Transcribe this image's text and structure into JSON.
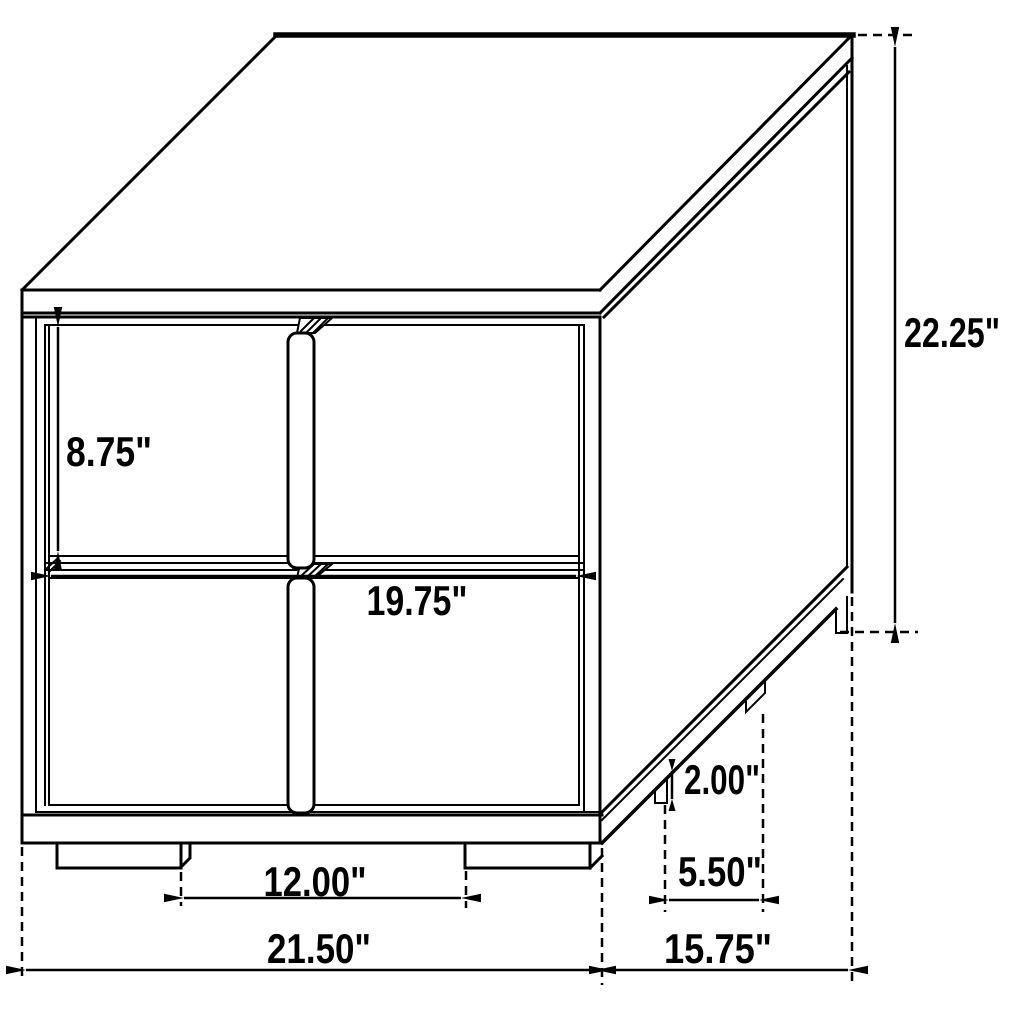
{
  "diagram": {
    "type": "furniture-dimension-drawing",
    "subject": "two-drawer nightstand isometric line drawing with dimensions",
    "units": "inches",
    "line_color": "#000000",
    "background_color": "#ffffff",
    "dimensions": {
      "overall_height": {
        "value": 22.25,
        "label": "22.25\""
      },
      "overall_width": {
        "value": 21.5,
        "label": "21.50\""
      },
      "overall_depth": {
        "value": 15.75,
        "label": "15.75\""
      },
      "drawer_front_height": {
        "value": 8.75,
        "label": "8.75\""
      },
      "drawer_front_width": {
        "value": 19.75,
        "label": "19.75\""
      },
      "front_leg_spacing": {
        "value": 12.0,
        "label": "12.00\""
      },
      "side_leg_spacing": {
        "value": 5.5,
        "label": "5.50\""
      },
      "leg_height": {
        "value": 2.0,
        "label": "2.00\""
      }
    }
  }
}
